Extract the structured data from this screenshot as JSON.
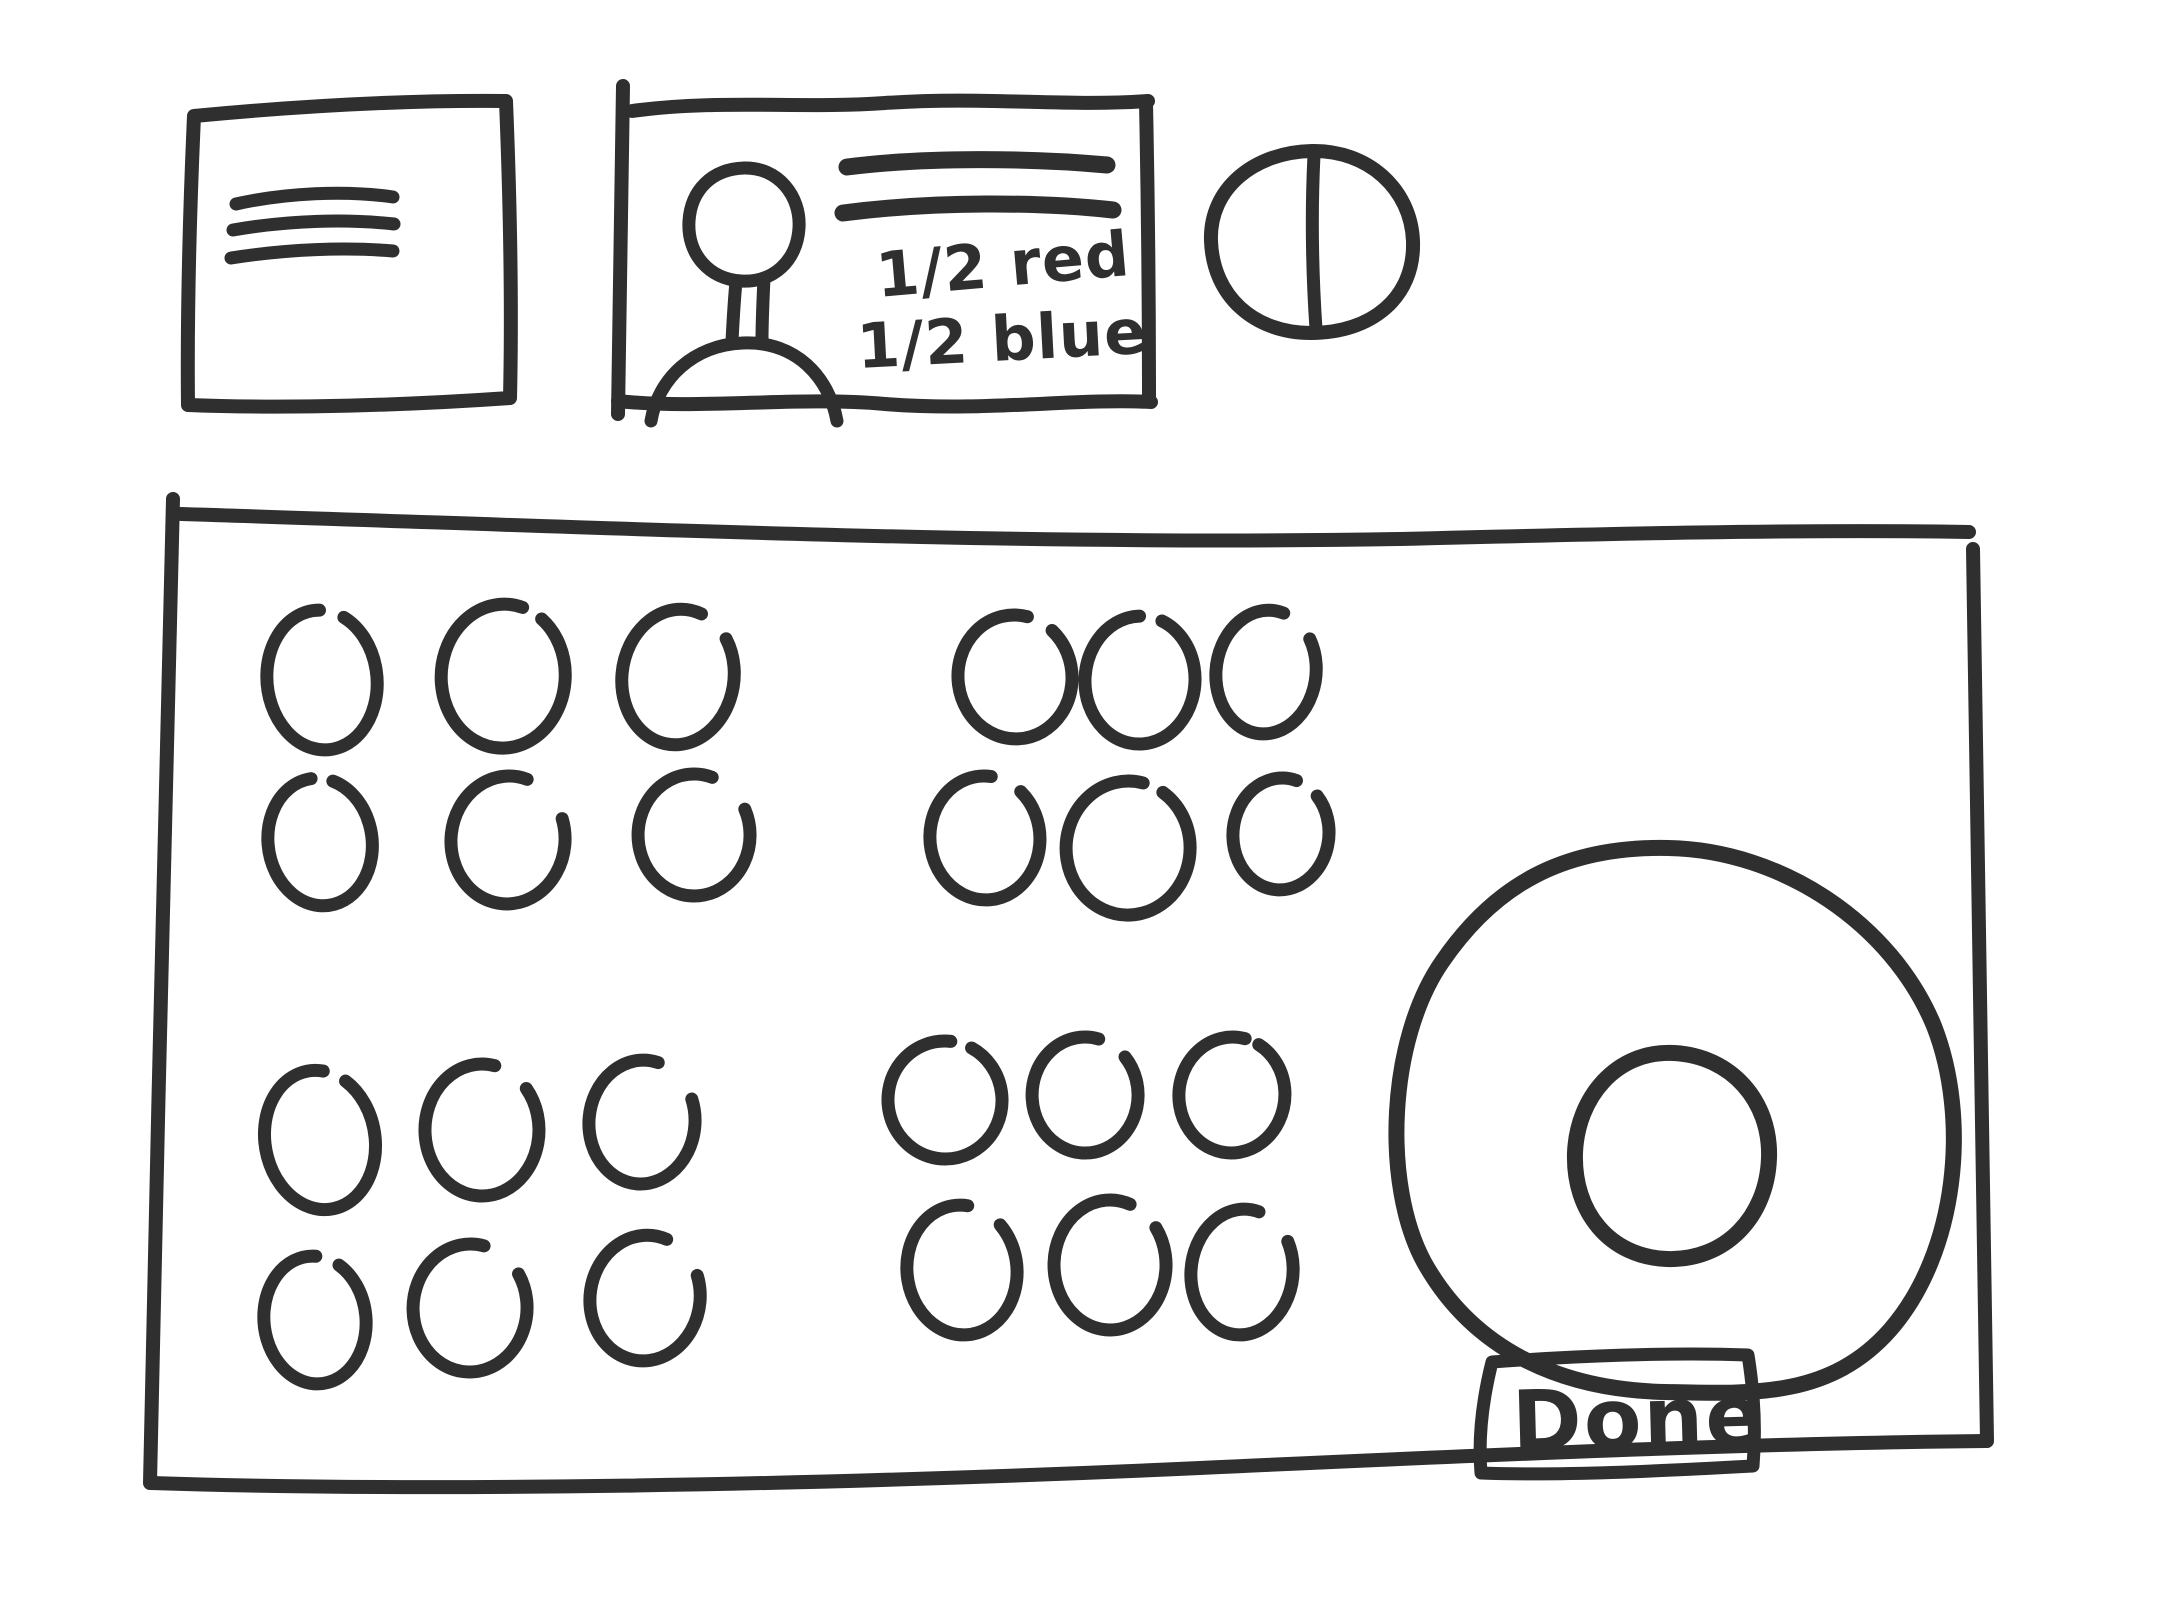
{
  "canvas": {
    "background": "#ffffff",
    "ink_color": "#2f2f2f",
    "style": "hand-drawn wireframe sketch"
  },
  "toolbar": {
    "menu_box": {
      "icon": "hamburger-menu-icon",
      "line_count": 3
    },
    "player_card": {
      "avatar_icon": "person-icon",
      "title_line_count": 2,
      "note_line1": "1/2 red",
      "note_line2": "1/2 blue"
    },
    "split_token": {
      "icon": "split-circle-icon"
    }
  },
  "board": {
    "bead_total": 24,
    "bead_clusters": [
      {
        "name": "top-left",
        "bead_count": 6,
        "beads": [
          [
            322,
            680,
            55,
            70,
            -6,
            26,
            -72
          ],
          [
            503,
            676,
            62,
            72,
            3,
            20,
            -65
          ],
          [
            678,
            677,
            56,
            68,
            8,
            34,
            -58
          ],
          [
            320,
            842,
            52,
            64,
            -8,
            24,
            -78
          ],
          [
            508,
            840,
            57,
            64,
            5,
            52,
            -50
          ],
          [
            694,
            835,
            56,
            61,
            0,
            46,
            -48
          ]
        ]
      },
      {
        "name": "top-right",
        "bead_count": 6,
        "beads": [
          [
            1015,
            677,
            57,
            62,
            -5,
            28,
            -58
          ],
          [
            1140,
            680,
            55,
            64,
            3,
            24,
            -82
          ],
          [
            1266,
            672,
            50,
            62,
            7,
            40,
            -58
          ],
          [
            985,
            838,
            55,
            62,
            -4,
            34,
            -62
          ],
          [
            1128,
            848,
            62,
            67,
            2,
            20,
            -68
          ],
          [
            1281,
            834,
            48,
            56,
            5,
            30,
            -62
          ]
        ]
      },
      {
        "name": "bottom-left",
        "bead_count": 6,
        "beads": [
          [
            320,
            1140,
            55,
            70,
            -10,
            24,
            -62
          ],
          [
            482,
            1130,
            57,
            66,
            0,
            38,
            -58
          ],
          [
            642,
            1122,
            53,
            62,
            5,
            52,
            -52
          ],
          [
            315,
            1320,
            51,
            64,
            -6,
            27,
            -68
          ],
          [
            470,
            1308,
            57,
            64,
            2,
            44,
            -56
          ],
          [
            645,
            1298,
            55,
            63,
            8,
            48,
            -52
          ]
        ]
      },
      {
        "name": "bottom-middle",
        "bead_count": 6,
        "beads": [
          [
            945,
            1100,
            57,
            59,
            -5,
            22,
            -68
          ],
          [
            1085,
            1095,
            53,
            58,
            0,
            34,
            -58
          ],
          [
            1232,
            1095,
            53,
            58,
            4,
            16,
            -72
          ],
          [
            962,
            1270,
            55,
            65,
            -6,
            38,
            -58
          ],
          [
            1110,
            1265,
            56,
            65,
            0,
            34,
            -52
          ],
          [
            1242,
            1272,
            51,
            63,
            6,
            44,
            -56
          ]
        ]
      }
    ],
    "target": {
      "icon": "donut-target-icon"
    },
    "done_button": {
      "label": "Done"
    }
  }
}
